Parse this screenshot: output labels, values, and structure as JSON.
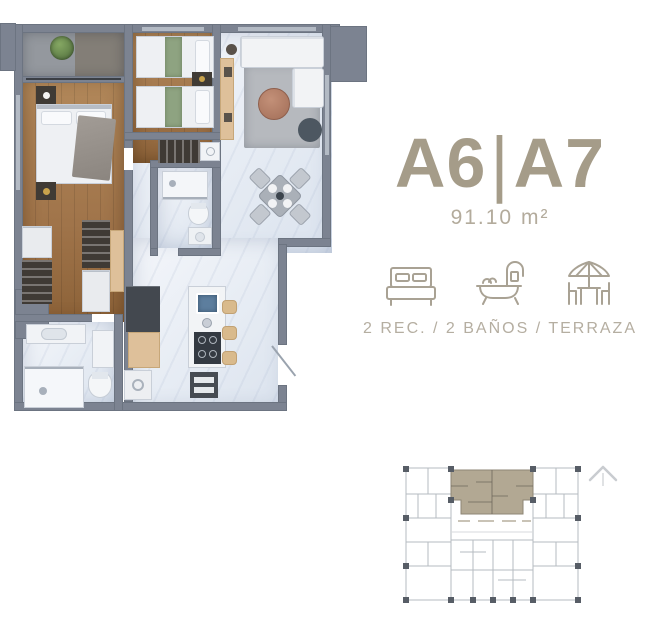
{
  "info": {
    "unit_left": "A6",
    "divider": "|",
    "unit_right": "A7",
    "area": "91.10 m²",
    "features_caption": "2 REC. / 2 BAÑOS / TERRAZA",
    "feature_icons": [
      "bed-icon",
      "bathtub-icon",
      "terrace-icon"
    ]
  },
  "colors": {
    "accent_taupe": "#a59c89",
    "area_gray": "#b3ab9c",
    "caption_gray": "#b5aea1",
    "wall_gray": "#7c8391",
    "wood": "#a87e52",
    "marble": "#eef1f6",
    "keyplan_highlight": "#b2a893"
  }
}
